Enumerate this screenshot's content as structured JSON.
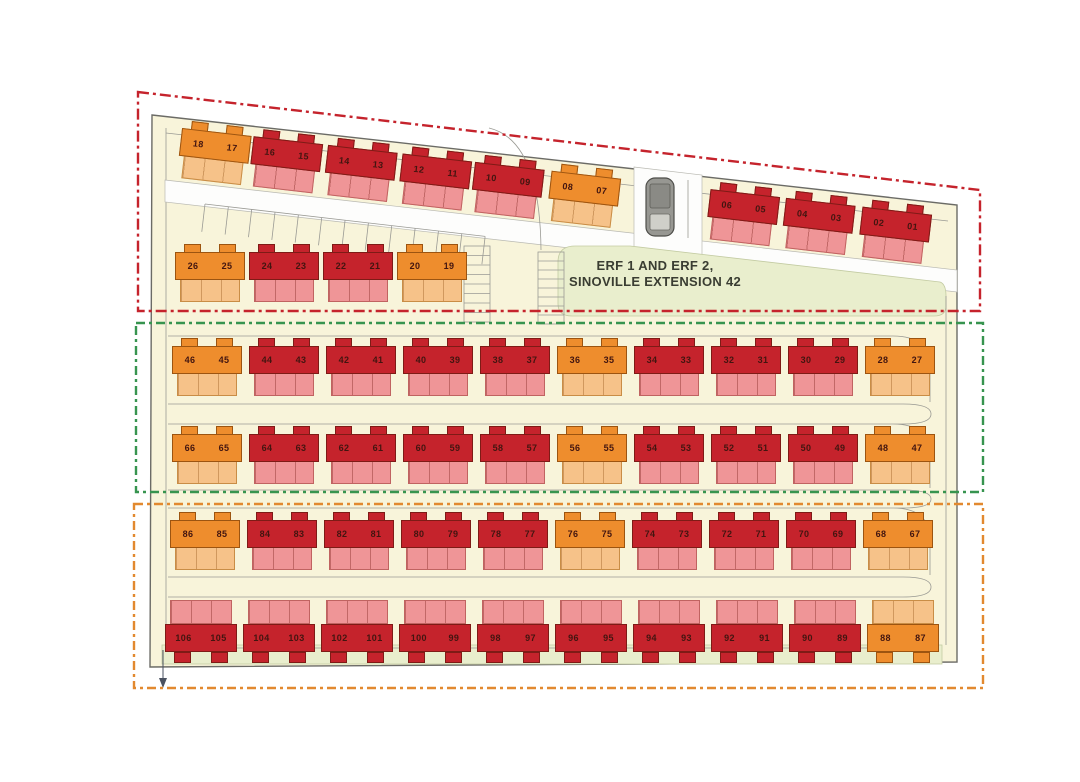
{
  "plan": {
    "erf_label": {
      "line1": "ERF 1 AND ERF 2,",
      "line2": "SINOVILLE EXTENSION 42"
    },
    "colors": {
      "red": "#c5232c",
      "pink": "#ef9597",
      "orange": "#ee8d2d",
      "lorange": "#f6c289",
      "cream": "#f8f4da",
      "pgreen": "#e9eecd",
      "bred": "#c5232c",
      "bgreen": "#37944f",
      "borange": "#e2892f",
      "ink": "#3a3d32"
    },
    "phases": [
      {
        "id": "phase-boundary-red",
        "color": "#c5232c",
        "style": "dash-dot"
      },
      {
        "id": "phase-boundary-green",
        "color": "#37944f",
        "style": "dash-dot"
      },
      {
        "id": "phase-boundary-orange",
        "color": "#e2892f",
        "style": "dash-dot"
      }
    ],
    "rows": {
      "row1L": {
        "blocks": [
          {
            "units": [
              "18",
              "17"
            ],
            "color": "orange"
          },
          {
            "units": [
              "16",
              "15"
            ],
            "color": "red"
          },
          {
            "units": [
              "14",
              "13"
            ],
            "color": "red"
          },
          {
            "units": [
              "12",
              "11"
            ],
            "color": "red"
          },
          {
            "units": [
              "10",
              "09"
            ],
            "color": "red"
          },
          {
            "units": [
              "08",
              "07"
            ],
            "color": "orange"
          }
        ]
      },
      "row1R": {
        "blocks": [
          {
            "units": [
              "06",
              "05"
            ],
            "color": "red"
          },
          {
            "units": [
              "04",
              "03"
            ],
            "color": "red"
          },
          {
            "units": [
              "02",
              "01"
            ],
            "color": "red"
          }
        ]
      },
      "row2": {
        "blocks": [
          {
            "units": [
              "26",
              "25"
            ],
            "color": "orange"
          },
          {
            "units": [
              "24",
              "23"
            ],
            "color": "red"
          },
          {
            "units": [
              "22",
              "21"
            ],
            "color": "red"
          },
          {
            "units": [
              "20",
              "19"
            ],
            "color": "orange"
          }
        ]
      },
      "row3": {
        "blocks": [
          {
            "units": [
              "46",
              "45"
            ],
            "color": "orange"
          },
          {
            "units": [
              "44",
              "43"
            ],
            "color": "red"
          },
          {
            "units": [
              "42",
              "41"
            ],
            "color": "red"
          },
          {
            "units": [
              "40",
              "39"
            ],
            "color": "red"
          },
          {
            "units": [
              "38",
              "37"
            ],
            "color": "red"
          },
          {
            "units": [
              "36",
              "35"
            ],
            "color": "orange"
          },
          {
            "units": [
              "34",
              "33"
            ],
            "color": "red"
          },
          {
            "units": [
              "32",
              "31"
            ],
            "color": "red"
          },
          {
            "units": [
              "30",
              "29"
            ],
            "color": "red"
          },
          {
            "units": [
              "28",
              "27"
            ],
            "color": "orange"
          }
        ]
      },
      "row4": {
        "blocks": [
          {
            "units": [
              "66",
              "65"
            ],
            "color": "orange"
          },
          {
            "units": [
              "64",
              "63"
            ],
            "color": "red"
          },
          {
            "units": [
              "62",
              "61"
            ],
            "color": "red"
          },
          {
            "units": [
              "60",
              "59"
            ],
            "color": "red"
          },
          {
            "units": [
              "58",
              "57"
            ],
            "color": "red"
          },
          {
            "units": [
              "56",
              "55"
            ],
            "color": "orange"
          },
          {
            "units": [
              "54",
              "53"
            ],
            "color": "red"
          },
          {
            "units": [
              "52",
              "51"
            ],
            "color": "red"
          },
          {
            "units": [
              "50",
              "49"
            ],
            "color": "red"
          },
          {
            "units": [
              "48",
              "47"
            ],
            "color": "orange"
          }
        ]
      },
      "row5": {
        "blocks": [
          {
            "units": [
              "86",
              "85"
            ],
            "color": "orange"
          },
          {
            "units": [
              "84",
              "83"
            ],
            "color": "red"
          },
          {
            "units": [
              "82",
              "81"
            ],
            "color": "red"
          },
          {
            "units": [
              "80",
              "79"
            ],
            "color": "red"
          },
          {
            "units": [
              "78",
              "77"
            ],
            "color": "red"
          },
          {
            "units": [
              "76",
              "75"
            ],
            "color": "orange"
          },
          {
            "units": [
              "74",
              "73"
            ],
            "color": "red"
          },
          {
            "units": [
              "72",
              "71"
            ],
            "color": "red"
          },
          {
            "units": [
              "70",
              "69"
            ],
            "color": "red"
          },
          {
            "units": [
              "68",
              "67"
            ],
            "color": "orange"
          }
        ]
      },
      "row6": {
        "blocks": [
          {
            "units": [
              "106",
              "105"
            ],
            "color": "red"
          },
          {
            "units": [
              "104",
              "103"
            ],
            "color": "red"
          },
          {
            "units": [
              "102",
              "101"
            ],
            "color": "red"
          },
          {
            "units": [
              "100",
              "99"
            ],
            "color": "red"
          },
          {
            "units": [
              "98",
              "97"
            ],
            "color": "red"
          },
          {
            "units": [
              "96",
              "95"
            ],
            "color": "red"
          },
          {
            "units": [
              "94",
              "93"
            ],
            "color": "red"
          },
          {
            "units": [
              "92",
              "91"
            ],
            "color": "red"
          },
          {
            "units": [
              "90",
              "89"
            ],
            "color": "red"
          },
          {
            "units": [
              "88",
              "87"
            ],
            "color": "orange"
          }
        ]
      }
    }
  }
}
